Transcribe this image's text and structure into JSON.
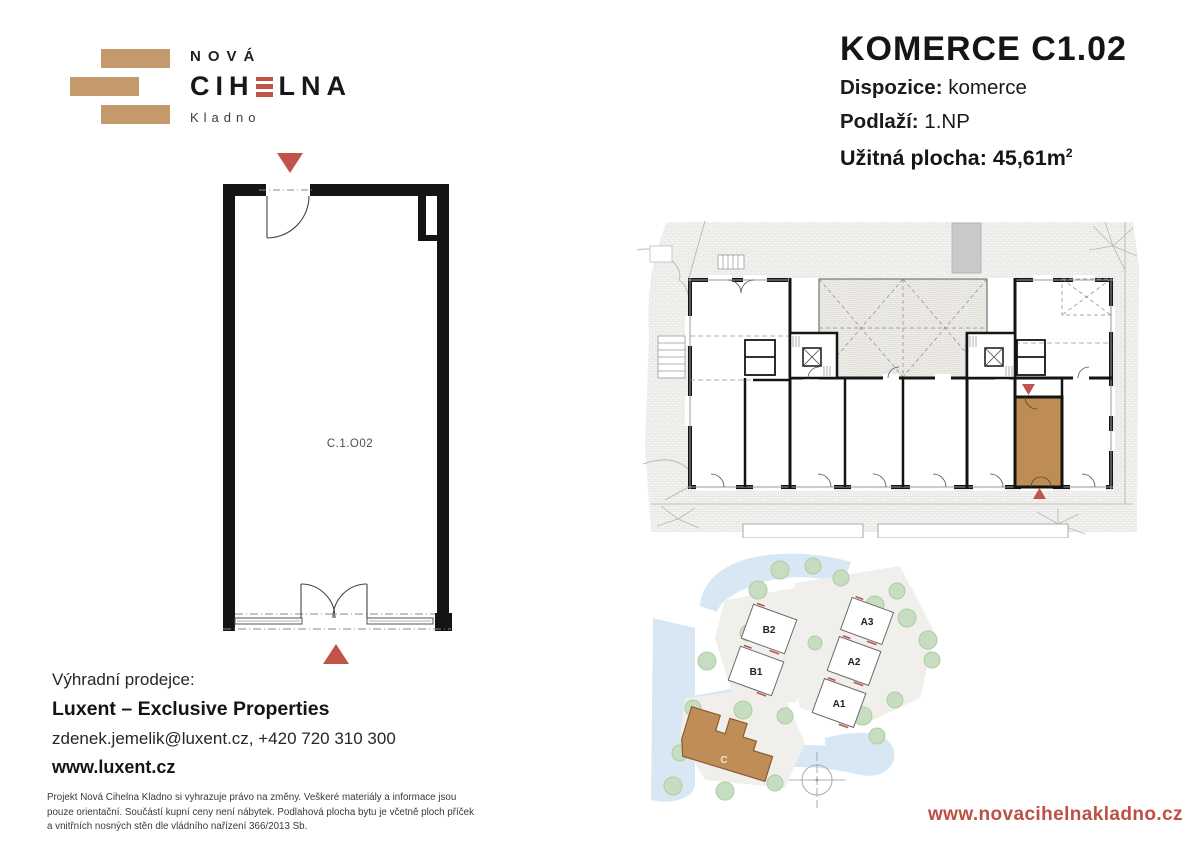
{
  "logo": {
    "top": "NOVÁ",
    "main_pre": "CIH",
    "main_post": "LNA",
    "sub": "Kladno"
  },
  "header": {
    "title": "KOMERCE C1.02",
    "rows": [
      {
        "label": "Dispozice:",
        "value": "komerce"
      },
      {
        "label": "Podlaží:",
        "value": "1.NP"
      }
    ],
    "area_label": "Užitná plocha:",
    "area_value": "45,61",
    "area_unit": "m",
    "area_exp": "2"
  },
  "unit_plan": {
    "room_label": "C.1.O02"
  },
  "site_plan": {
    "buildings": [
      {
        "label": "B2"
      },
      {
        "label": "B1"
      },
      {
        "label": "A3"
      },
      {
        "label": "A2"
      },
      {
        "label": "A1"
      }
    ],
    "building_c_label": "C"
  },
  "seller": {
    "heading": "Výhradní prodejce:",
    "name": "Luxent – Exclusive Properties",
    "contact": "zdenek.jemelik@luxent.cz, +420 720 310 300",
    "web": "www.luxent.cz"
  },
  "disclaimer": "Projekt Nová Cihelna Kladno si vyhrazuje právo na změny. Veškeré materiály a informace jsou pouze orientační. Součástí kupní ceny není nábytek. Podlahová plocha bytu je včetně ploch příček a vnitřních nosných stěn dle vládního nařízení 366/2013 Sb.",
  "footer": {
    "website": "www.novacihelnakladno.cz"
  },
  "colors": {
    "brand_tan": "#C49A6C",
    "brand_red": "#C0544B",
    "unit_highlight": "#BE8C55",
    "road_blue": "#D7E8F4",
    "tree_green": "#C7DDC0"
  }
}
